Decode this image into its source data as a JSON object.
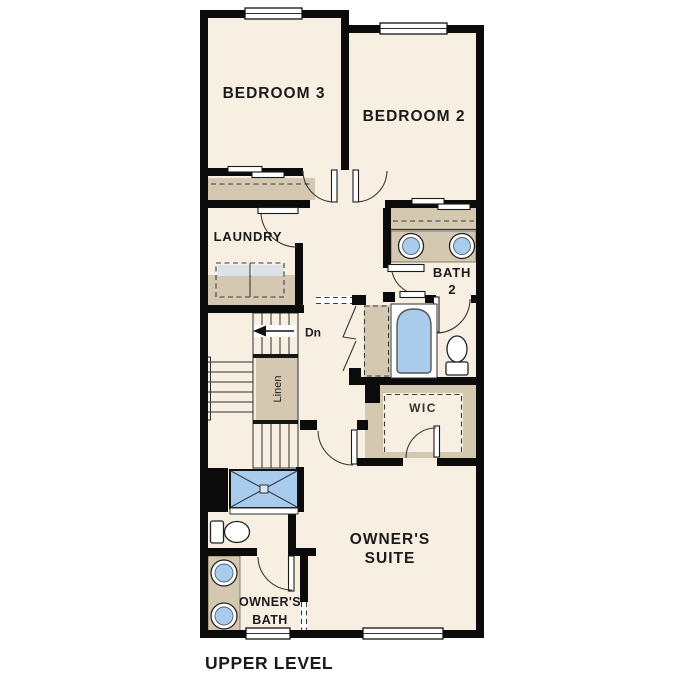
{
  "plan": {
    "title": "UPPER LEVEL",
    "rooms": {
      "bedroom3": "BEDROOM 3",
      "bedroom2": "BEDROOM 2",
      "laundry": "LAUNDRY",
      "bath2_line1": "BATH",
      "bath2_line2": "2",
      "stairs_direction": "Dn",
      "linen": "Linen",
      "wic": "WIC",
      "owners_suite_line1": "OWNER'S",
      "owners_suite_line2": "SUITE",
      "owners_bath_line1": "OWNER'S",
      "owners_bath_line2": "BATH"
    },
    "colors": {
      "wall": "#0b0b0b",
      "room_fill": "#f7efe2",
      "cabinet_tan": "#d5c8b0",
      "fixture_blue": "#a9cbec",
      "appliance_top_gray": "#dce3e8",
      "shower_center": "#d8e6f5",
      "text": "#1a1a1a",
      "background": "#ffffff"
    }
  }
}
